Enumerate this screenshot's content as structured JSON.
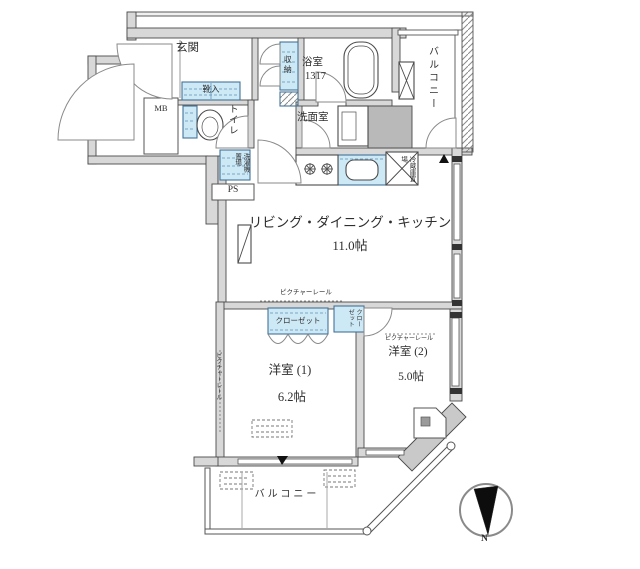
{
  "plan": {
    "entrance": {
      "label": "玄関",
      "shoe_cabinet": "靴入",
      "meter_box": "MB"
    },
    "toilet": {
      "label": "トイレ"
    },
    "storage": {
      "label": "収納"
    },
    "bathroom": {
      "label": "浴室",
      "size_code": "1317"
    },
    "washroom": {
      "label": "洗面室"
    },
    "balcony_upper": {
      "label": "バルコニー"
    },
    "balcony_lower": {
      "label": "バルコニー"
    },
    "utilities": {
      "washer_place": "洗濯機置場",
      "pipe_space": "PS",
      "fridge_place": "冷蔵庫置場"
    },
    "ldk": {
      "label": "リビング・ダイニング・キッチン",
      "size": "11.0帖"
    },
    "closet_main": {
      "label": "クローゼット"
    },
    "closet_small": {
      "label": "クローゼット"
    },
    "room1": {
      "label": "洋室 (1)",
      "size": "6.2帖",
      "picture_rail": "ピクチャーレール"
    },
    "room2": {
      "label": "洋室 (2)",
      "size": "5.0帖",
      "picture_rail": "ピクチャーレール"
    },
    "ldk_picture_rail": "ピクチャーレール",
    "compass": {
      "north": "N"
    },
    "colors": {
      "wall_fill": "#d8d8d8",
      "shaft_fill": "#b9b9b9",
      "fixture_blue": "#cde9f6",
      "fixture_blue_border": "#44749a",
      "line": "#4a4a4a",
      "text": "#2e2e2e"
    }
  }
}
